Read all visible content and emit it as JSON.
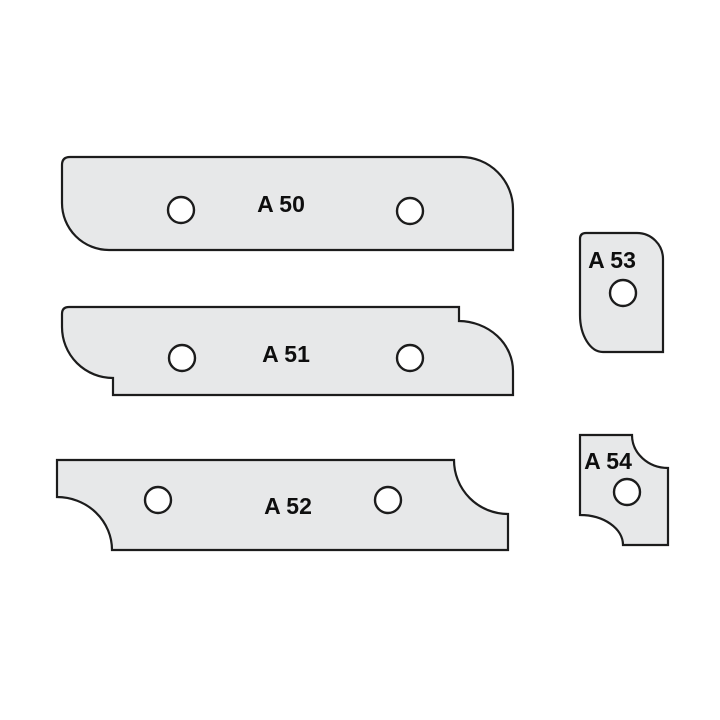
{
  "colors": {
    "background": "#ffffff",
    "blade_fill": "#e7e8e9",
    "outline": "#1c1c1c",
    "hole_fill": "#ffffff",
    "label": "#0e0e0e"
  },
  "knives": [
    {
      "id": "A50",
      "label": "A 50",
      "path": "M 70 157 L 461 157 A 52 52 0 0 1 513 209 L 513 250 L 109 250 A 47 47 0 0 1 62 203 L 62 165 Q 62 157 70 157 Z",
      "label_x": 281,
      "label_y": 212,
      "holes": [
        {
          "cx": 181,
          "cy": 210,
          "r": 13
        },
        {
          "cx": 410,
          "cy": 211,
          "r": 13
        }
      ]
    },
    {
      "id": "A51",
      "label": "A 51",
      "path": "M 69 307 L 459 307 L 459 321 A 55 50 0 0 1 513 371 L 513 395 L 113 395 L 113 378 A 51 51 0 0 1 62 327 L 62 314 Q 62 307 69 307 Z",
      "label_x": 286,
      "label_y": 362,
      "holes": [
        {
          "cx": 182,
          "cy": 358,
          "r": 13
        },
        {
          "cx": 410,
          "cy": 358,
          "r": 13
        }
      ]
    },
    {
      "id": "A52",
      "label": "A 52",
      "path": "M 57 460 L 454 460 A 54 54 0 0 0 508 514 L 508 550 L 112 550 A 55 53 0 0 0 57 497 L 57 460 Z",
      "label_x": 288,
      "label_y": 514,
      "holes": [
        {
          "cx": 158,
          "cy": 500,
          "r": 13
        },
        {
          "cx": 388,
          "cy": 500,
          "r": 13
        }
      ]
    },
    {
      "id": "A53",
      "label": "A 53",
      "path": "M 586 233 L 637 233 A 26 26 0 0 1 663 259 L 663 352 L 603 352 A 23 37 0 0 1 580 315 L 580 239 Q 580 233 586 233 Z",
      "label_x": 612,
      "label_y": 268,
      "holes": [
        {
          "cx": 623,
          "cy": 293,
          "r": 13
        }
      ]
    },
    {
      "id": "A54",
      "label": "A 54",
      "path": "M 580 435 L 632 435 A 36 33 0 0 0 668 468 L 668 545 L 623 545 A 43 30 0 0 0 580 515 L 580 435 Z",
      "label_x": 608,
      "label_y": 469,
      "holes": [
        {
          "cx": 627,
          "cy": 492,
          "r": 13
        }
      ]
    }
  ]
}
